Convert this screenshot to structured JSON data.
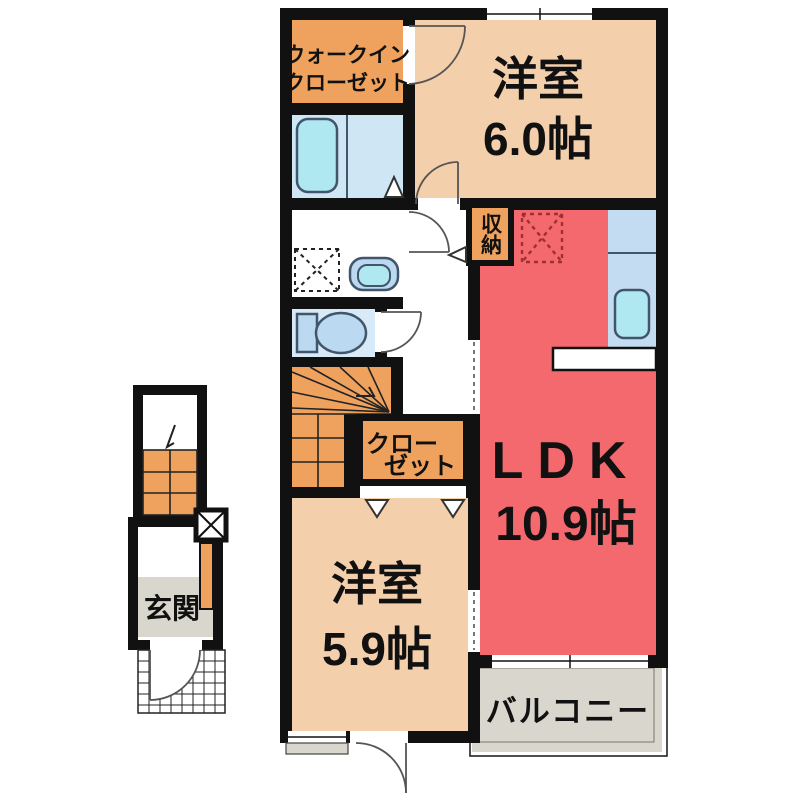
{
  "plan": {
    "type": "floorplan",
    "rooms": {
      "walk_in_closet": {
        "line1": "ウォークイン",
        "line2": "クローゼット"
      },
      "bedroom_6": {
        "name": "洋室",
        "area": "6.0帖"
      },
      "storage": {
        "label": "収納"
      },
      "ldk": {
        "name": "LDK",
        "area": "10.9帖"
      },
      "closet": {
        "line1": "クロー",
        "line2": "ゼット"
      },
      "bedroom_59": {
        "name": "洋室",
        "area": "5.9帖"
      },
      "balcony": {
        "label": "バルコニー"
      },
      "entrance": {
        "label": "玄関"
      }
    },
    "colors": {
      "wall": "#111111",
      "room_orange": "#efa25e",
      "room_peach": "#f3cfab",
      "room_red": "#f4696e",
      "bath_blue": "#cfe6f5",
      "kitchen_blue": "#c4dcf2",
      "toilet_blue": "#d8eaf7",
      "fixture_blue": "#bcd9f2",
      "water_cyan": "#b0e8f1",
      "gray": "#d9d6ce",
      "white": "#ffffff",
      "fridge_dash": "#a03030"
    }
  }
}
